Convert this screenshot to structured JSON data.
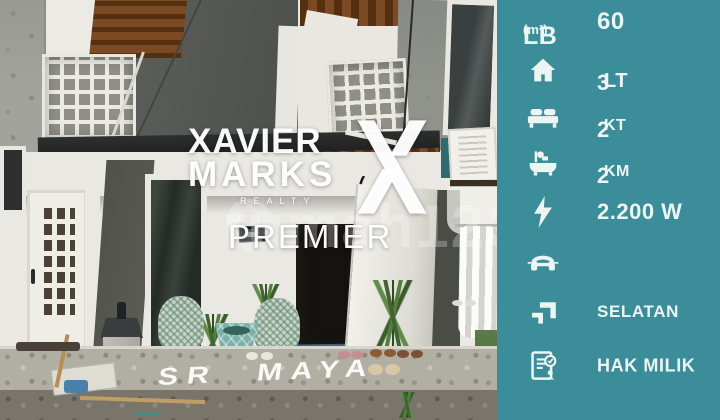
{
  "colors": {
    "sidebar_bg": "#3a8d99",
    "sidebar_text": "#edf5f4"
  },
  "photo": {
    "agency_watermark": {
      "line1": "XAVIER",
      "line2": "MARKS",
      "subline": "REALTY",
      "line3": "PREMIER"
    },
    "portal_watermark": "rumah123",
    "ground_text": "SR MAYA"
  },
  "sidebar": {
    "rows": [
      {
        "name": "building-area",
        "label": "LB",
        "label_unit": "(m²)",
        "value": "60"
      },
      {
        "name": "floors",
        "icon": "house-icon",
        "value": "3",
        "unit": "LT"
      },
      {
        "name": "bedrooms",
        "icon": "bed-icon",
        "value": "2",
        "unit": "KT"
      },
      {
        "name": "bathrooms",
        "icon": "bath-icon",
        "value": "2",
        "unit": "KM"
      },
      {
        "name": "electricity",
        "icon": "lightning-icon",
        "value": "2.200 W",
        "unit": ""
      },
      {
        "name": "carport",
        "icon": "car-icon",
        "value": "",
        "unit": ""
      },
      {
        "name": "facing",
        "icon": "direction-icon",
        "value": "SELATAN",
        "unit": ""
      },
      {
        "name": "certificate",
        "icon": "certificate-icon",
        "value": "HAK MILIK",
        "unit": ""
      }
    ]
  }
}
